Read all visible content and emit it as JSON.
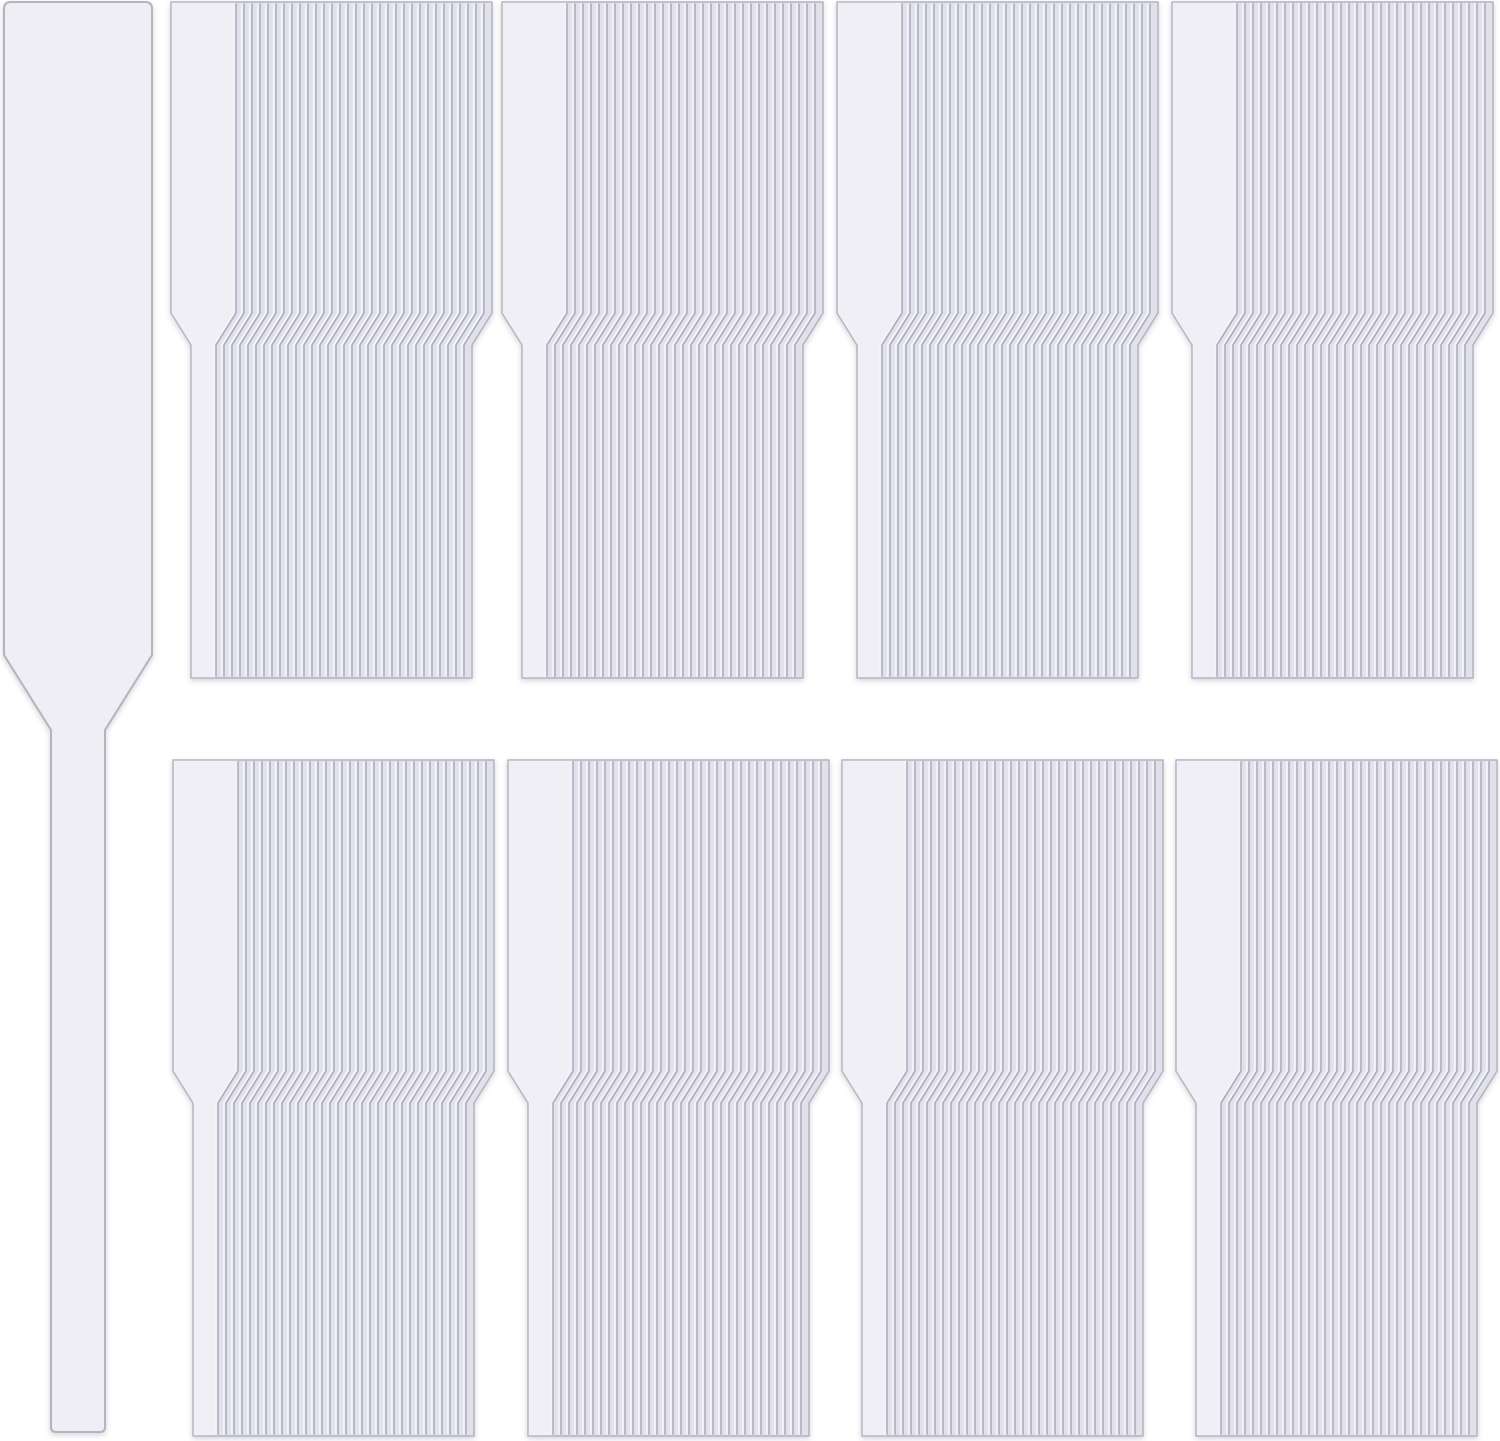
{
  "scene": {
    "type": "product-photo",
    "subject": "clear plastic T-shaped plant nursery labels: one single label at left and eight fanned stacks arranged in two rows of four",
    "viewbox": "0 0 1500 1441",
    "canvas": {
      "width": 1500,
      "height": 1441
    },
    "background": "#ffffff",
    "colors": {
      "tag_face": "#efeff5",
      "stack_fill": "#e1e1ec",
      "edge_dark": "#a6a6b7",
      "edge_highlight": "#f2f2f8",
      "outline": "#b4b4c1",
      "single_label_fill": "#eeeef4",
      "single_label_outline": "#b4b4c0",
      "shadow": "rgba(110,110,135,0.30)"
    },
    "single_label": {
      "x": 4,
      "y": 2,
      "blade_width": 148,
      "blade_bottom": 655,
      "stem_top": 730,
      "stem_width": 54,
      "stem_bottom": 1432,
      "corner_radius": 7,
      "bottom_radius": 5
    },
    "stack_template": {
      "width": 321,
      "height": 676,
      "face_width": 65,
      "fan_step": 8,
      "taper_inset": 20,
      "band_top": 311,
      "band_height": 32,
      "tags_per_stack": 33
    },
    "stack_rows": [
      {
        "y": 2,
        "xs": [
          171,
          502,
          837,
          1172
        ]
      },
      {
        "y": 760,
        "xs": [
          173,
          508,
          842,
          1176
        ]
      }
    ],
    "counts": {
      "single_labels": 1,
      "stacks": 8,
      "rows": 2,
      "stacks_per_row": 4
    }
  }
}
